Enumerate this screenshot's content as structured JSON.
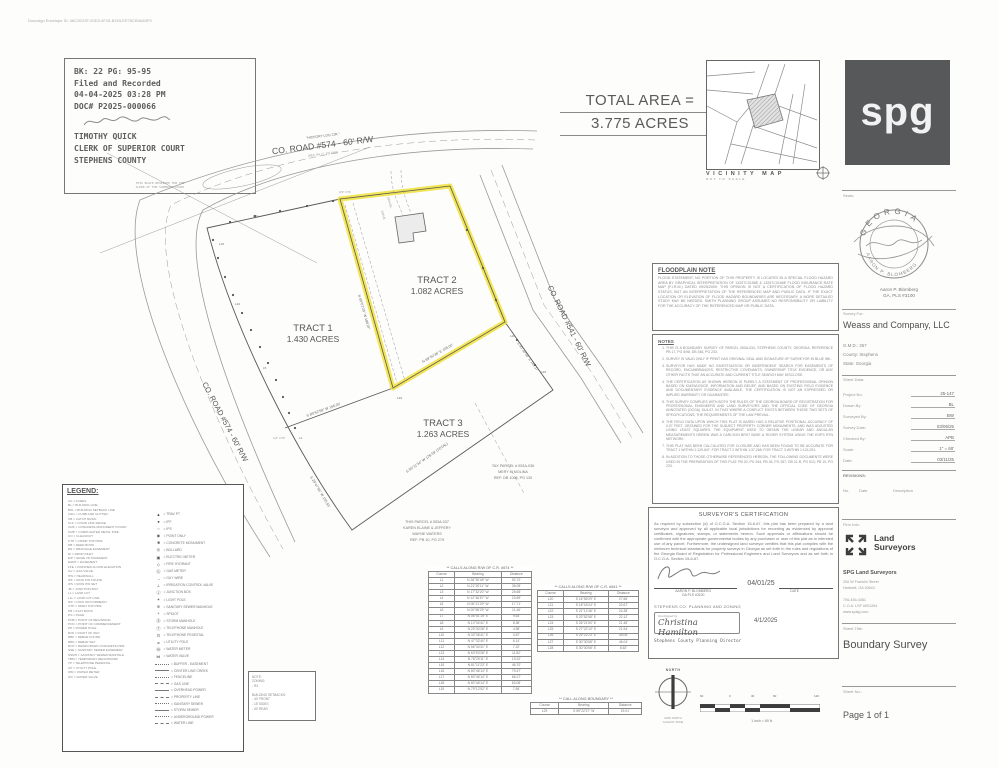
{
  "page": {
    "envelope_id": "Docusign Envelope ID: 46C2E23F-53D3-4F15-B153-EE76CB3A63F9"
  },
  "stamp": {
    "line1": "BK: 22 PG: 95-95",
    "line2": "Filed and Recorded",
    "line3": "04-04-2025 03:28 PM",
    "line4": "DOC# P2025-000066",
    "name": "TIMOTHY QUICK",
    "title": "CLERK OF SUPERIOR COURT",
    "county": "STEPHENS COUNTY",
    "footnote1": "THIS BLOCK RESERVED FOR THE",
    "footnote2": "CLERK OF THE SUPERIOR COURT"
  },
  "total_area": {
    "label": "TOTAL AREA =",
    "value": "3.775 ACRES"
  },
  "vicinity": {
    "title": "VICINITY MAP",
    "subtitle": "NOT TO SCALE"
  },
  "logo": {
    "text": "spg",
    "bg": "#57585a"
  },
  "drawing": {
    "road_top_name": "\"HICKORY LOG CIR.\"",
    "road_top": "CO. ROAD #574 - 60' R/W",
    "road_top_ref": "(REF. PB 17, PG 5/98)",
    "road_left": "CO. ROAD #574 - 60' R/W",
    "road_right": "CO. ROAD #541 - 60' R/W",
    "tract1_name": "TRACT 1",
    "tract1_area": "1.430 ACRES",
    "tract2_name": "TRACT 2",
    "tract2_area": "1.082 ACRES",
    "tract3_name": "TRACT 3",
    "tract3_area": "1.263 ACRES",
    "highlight_color": "#f0e13a",
    "gravel": "GRAVEL",
    "drive": "DRIVE",
    "bearings": [
      "N 00°07'26\" W  188.97'",
      "N 89°50'38\" E  165.00'",
      "S 89°52'58\" W  165.00'",
      "S 30°30'58\" E  141.17'",
      "S 59°11'34\" W  178.59' (TOTAL)",
      "S 29°47'56\" W  155.55'"
    ],
    "course_marks": [
      "L1",
      "L5",
      "L10",
      "L15",
      "L19",
      "L20",
      "L25",
      "L29"
    ],
    "corner_marks": [
      "3/4\" CTF",
      "1/2\" CTP"
    ],
    "adjoiner1": [
      "TAX PARCEL # 053A-036",
      "MERY M MOLINA",
      "REF: DB 1098, PG 130"
    ],
    "adjoiner2": [
      "THIS PARCEL # 053A-037",
      "KAREN ELAINE & JEFFERY",
      "WAYNE WATERS",
      "REF: PB 10, PG 279"
    ]
  },
  "floodplain": {
    "title": "FLOODPLAIN NOTE",
    "body": "FLOOD STATEMENT: NO PORTION OF THIS PROPERTY IS LOCATED IN A SPECIAL FLOOD HAZARD AREA BY GRAPHICAL INTERPRETATION OF 13257C0158E & 13257C0166E FLOOD INSURANCE RATE MAP (F.I.R.M.) DATED 09/25/2009. THIS OPINION IS NOT A CERTIFICATION OF FLOOD HAZARD STATUS, BUT AN INTERPRETATION OF THE REFERENCED MAP AND PUBLIC DATA. IF THE EXACT LOCATION OR ELEVATION OF FLOOD HAZARD BOUNDARIES ARE NECESSARY, A MORE DETAILED STUDY MAY BE NEEDED. SMITH PLANNING GROUP ASSUMES NO RESPONSIBILITY OR LIABILITY FOR THE ACCURACY OF THE REFERENCED MAP OR PUBLIC DATA."
  },
  "notes": {
    "title": "NOTES",
    "items": [
      "THIS IS A BOUNDARY SURVEY OF PARCEL 053A-034, STEPHENS COUNTY, GEORGIA. REFERENCE PB 17, PG 5/98; DB 346, PG 233.",
      "SURVEY IS VALID ONLY IF PRINT HAS ORIGINAL SEAL AND SIGNATURE OF SURVEYOR IN BLUE INK.",
      "SURVEYOR HAS MADE NO INVESTIGATION OR INDEPENDENT SEARCH FOR EASEMENTS OF RECORD, ENCUMBRANCES, RESTRICTIVE COVENANTS, OWNERSHIP TITLE EVIDENCE, OR ANY OTHER FACTS THAT AN ACCURATE AND CURRENT TITLE SEARCH MAY DISCLOSE.",
      "THE CERTIFICATION AS SHOWN HEREON IS PURELY A STATEMENT OF PROFESSIONAL OPINION BASED ON KNOWLEDGE, INFORMATION AND BELIEF, AND BASED ON EXISTING FIELD EVIDENCE AND DOCUMENTARY EVIDENCE AVAILABLE. THE CERTIFICATION IS NOT AN EXPRESSED OR IMPLIED WARRANTY OR GUARANTEE.",
      "THIS SURVEY COMPLIES WITH BOTH THE RULES OF THE GEORGIA BOARD OF REGISTRATION FOR PROFESSIONAL ENGINEERS AND LAND SURVEYORS AND THE OFFICIAL CODE OF GEORGIA ANNOTATED (OCGA) 15-6-67, IN THAT WHERE A CONFLICT EXISTS BETWEEN THOSE TWO SETS OF SPECIFICATIONS, THE REQUIREMENTS OF THE LAW PREVAIL.",
      "THE FIELD DATA UPON WHICH THIS PLAT IS BASED HAS A RELATIVE POSITIONAL ACCURACY OF 0.07 FEET, OBTAINED FOR THE SUBJECT PROPERTY CORNER MONUMENTS, AND WAS ADJUSTED USING LEAST SQUARES. THE EQUIPMENT USED TO OBTAIN THE LINEAR AND ANGULAR MEASUREMENTS HEREIN WAS A CARLSON BRX7 BASE & ROVER SYSTEM USING THE EGPS RTN NETWORK.",
      "THIS PLAT HAS BEEN CALCULATED FOR CLOSURE AND HAS BEEN FOUND TO BE ACCURATE FOR TRACT 1 WITHIN 1:129,847; FOR TRACT 2 WITHIN 1:37,268; FOR TRACT 3 WITHIN 1:124,291.",
      "IN ADDITION TO THOSE OTHERWISE REFERENCED HEREON, THE FOLLOWING DOCUMENTS WERE USED IN THE PREPARATION OF THIS PLAT: PB 20, PG 264; PB 28, PG 257; DB 21-R, PG 513; PB 10, PG 233."
    ]
  },
  "certification": {
    "title": "SURVEYOR'S CERTIFICATION",
    "body": "As required by subsection (d) of O.C.G.A. Section 15-6-67, this plat has been prepared by a land surveyor and approved by all applicable local jurisdictions for recording as evidenced by approval certificates, signatures, stamps, or statements hereon. Such approvals or affirmations should be confirmed with the appropriate governmental bodies by any purchaser or user of this plat as to intended use of any parcel. Furthermore, the undersigned land surveyor certifies that this plat complies with the minimum technical standards for property surveys in Georgia as set forth in the rules and regulations of the Georgia Board of Registration for Professional Engineers and Land Surveyors and as set forth in O.C.G.A. Section 15-6-67.",
    "date": "04/01/25",
    "surveyor_name": "AARON P. BLOMBERG",
    "surveyor_license": "GA PLS #3100",
    "date_label": "DATE",
    "agency": "STEPHENS CO. PLANNING AND ZONING",
    "ds_label": "DocuSigned by:",
    "ds_signature": "Christina Hamilton",
    "approval_date": "4/1/2025",
    "approver_title": "Stephens County Planning Director"
  },
  "legend": {
    "title": "LEGEND:",
    "abbreviations": [
      "AC = ACRES",
      "BL = BUILDING LINE",
      "BSL = BUILDING SETBACK LINE",
      "C&G = CURB AND GUTTER",
      "CB = CATCH BASIN",
      "CLF = CHAIN LINK FENCE",
      "CMF = CONCRETE MONUMENT FOUND",
      "CMP = CORRUGATED METAL PIPE",
      "CO = CLEANOUT",
      "CTP = CRIMP TOP PIPE",
      "DB = DEED BOOK",
      "DE = DRAINAGE EASEMENT",
      "DI = DROP INLET",
      "E/P = EDGE OF PAVEMENT",
      "ESMT = EASEMENT",
      "FFE = FINISHED FLOOR ELEVATION",
      "GV = GAS VALVE",
      "HW = HEADWALL",
      "IPF = IRON PIN FOUND",
      "IPS = IRON PIN SET",
      "JB = JUNCTION BOX",
      "LL = LAND LOT",
      "LLL = LAND LOT LINE",
      "N/F = NOW OR FORMERLY",
      "OTP = OPEN TOP PIPE",
      "PB = PLAT BOOK",
      "PG = PAGE",
      "POB = POINT OF BEGINNING",
      "POC = POINT OF COMMENCEMENT",
      "PP = POWER POLE",
      "R/W = RIGHT OF WAY",
      "RBF = REBAR FOUND",
      "RBS = REBAR SET",
      "RCP = REINFORCED CONCRETE PIPE",
      "SSE = SANITARY SEWER EASEMENT",
      "SSMH = SANITARY SEWER MANHOLE",
      "TBM = TEMPORARY BENCHMARK",
      "TP = TELEPHONE PEDESTAL",
      "UP = UTILITY POLE",
      "WM = WATER METER",
      "WV = WATER VALVE"
    ],
    "symbols": [
      {
        "g": "▲",
        "t": "= TRAV PT"
      },
      {
        "g": "●",
        "t": "= IPF"
      },
      {
        "g": "○",
        "t": "= IPS"
      },
      {
        "g": "◉",
        "t": "= POINT ONLY"
      },
      {
        "g": "■",
        "t": "= CONCRETE MONUMENT"
      },
      {
        "g": "◎",
        "t": "= BOLLARD"
      },
      {
        "g": "▣",
        "t": "= ELECTRIC METER"
      },
      {
        "g": "◇",
        "t": "= FIRE HYDRANT"
      },
      {
        "g": "Ⓖ",
        "t": "= GAS METER"
      },
      {
        "g": "→",
        "t": "= GUY WIRE"
      },
      {
        "g": "⊥",
        "t": "= IRRIGATION CONTROL VALVE"
      },
      {
        "g": "Ⓙ",
        "t": "= JUNCTION BOX"
      },
      {
        "g": "✶",
        "t": "= LIGHT POLE"
      },
      {
        "g": "⊕",
        "t": "= SANITARY SEWER MANHOLE"
      },
      {
        "g": "+",
        "t": "= SPIGOT"
      },
      {
        "g": "Ⓢ",
        "t": "= STORM MANHOLE"
      },
      {
        "g": "Ⓣ",
        "t": "= TELEPHONE MANHOLE"
      },
      {
        "g": "⊡",
        "t": "= TELEPHONE PEDESTAL"
      },
      {
        "g": "⌀",
        "t": "= UTILITY POLE"
      },
      {
        "g": "Ⓦ",
        "t": "= WATER METER"
      },
      {
        "g": "⋈",
        "t": "= WATER VALVE"
      }
    ],
    "linetypes": [
      "= BUFFER - EASEMENT",
      "= CENTER LINE CREEK",
      "= FENCELINE",
      "= GAS LINE",
      "= OVERHEAD POWER",
      "= PROPERTY LINE",
      "= SANITARY SEWER",
      "= STORM SEWER",
      "= UNDERGROUND POWER",
      "= WATER LINE"
    ]
  },
  "zoning_box": {
    "lines": [
      "NOTE:",
      "ZONING:",
      "- R3",
      "",
      "BUILDING SETBACKS:",
      "- 40' FRONT",
      "- 15' SIDES",
      "- 40' REAR"
    ]
  },
  "tables": {
    "t1": {
      "title": "** CALLS ALONG R/W OF C.R. #574 **",
      "headers": [
        "Course",
        "Bearing",
        "Distance"
      ],
      "rows": [
        {
          "c": "L1",
          "b": "N 26°30'48\" W",
          "d": "52.72'"
        },
        {
          "c": "L2",
          "b": "N 21°20'11\" W",
          "d": "36.08'"
        },
        {
          "c": "L3",
          "b": "N 17°32'20\" W",
          "d": "25.68'"
        },
        {
          "c": "L4",
          "b": "N 12°46'57\" W",
          "d": "23.69'"
        },
        {
          "c": "L5",
          "b": "N 06°21'29\" W",
          "d": "17.71'"
        },
        {
          "c": "L6",
          "b": "N 00°58'29\" W",
          "d": "11.46'"
        },
        {
          "c": "L7",
          "b": "N 06°51'19\" E",
          "d": "9.63'"
        },
        {
          "c": "L8",
          "b": "N 10°34'41\" E",
          "d": "8.36'"
        },
        {
          "c": "L9",
          "b": "N 25°30'28\" E",
          "d": "4.98'"
        },
        {
          "c": "L10",
          "b": "N 33°36'41\" E",
          "d": "3.87'"
        },
        {
          "c": "L11",
          "b": "N 47°32'40\" E",
          "d": "6.14'"
        },
        {
          "c": "L12",
          "b": "N 56°34'31\" E",
          "d": "7.22'"
        },
        {
          "c": "L13",
          "b": "N 63°53'28\" E",
          "d": "11.82'"
        },
        {
          "c": "L14",
          "b": "N 78°29'11\" E",
          "d": "19.22'"
        },
        {
          "c": "L15",
          "b": "N 81°11'23\" E",
          "d": "46.70'"
        },
        {
          "c": "L16",
          "b": "N 80°46'14\" E",
          "d": "79.47'"
        },
        {
          "c": "L17",
          "b": "N 80°46'14\" E",
          "d": "66.27'"
        },
        {
          "c": "L18",
          "b": "N 80°46'14\" E",
          "d": "63.08'"
        },
        {
          "c": "L19",
          "b": "N 79°12'52\" E",
          "d": "7.84'"
        }
      ]
    },
    "t2": {
      "title": "** CALLS ALONG R/W OF C.R. #541 **",
      "headers": [
        "Course",
        "Bearing",
        "Distance"
      ],
      "rows": [
        {
          "c": "L20",
          "b": "S 16°55'29\" E",
          "d": "27.66'"
        },
        {
          "c": "L21",
          "b": "S 18°18'24\" E",
          "d": "20.67'"
        },
        {
          "c": "L22",
          "b": "S 21°12'46\" E",
          "d": "24.38'"
        },
        {
          "c": "L23",
          "b": "S 23°52'58\" E",
          "d": "22.12'"
        },
        {
          "c": "L24",
          "b": "S 26°21'50\" E",
          "d": "21.48'"
        },
        {
          "c": "L25",
          "b": "S 27°22'10\" E",
          "d": "21.54'"
        },
        {
          "c": "L26",
          "b": "S 29°22'23\" E",
          "d": "45.05'"
        },
        {
          "c": "L27",
          "b": "S 30°30'58\" E",
          "d": "46.04'"
        },
        {
          "c": "L28",
          "b": "S 30°30'58\" E",
          "d": "8.63'"
        }
      ]
    },
    "t3": {
      "title": "** CALL ALONG BOUNDARY **",
      "headers": [
        "Course",
        "Bearing",
        "Distance"
      ],
      "rows": [
        {
          "c": "L29",
          "b": "S 59°22'37\" W",
          "d": "19.01'"
        }
      ]
    }
  },
  "compass": {
    "label": "NORTH",
    "sub1": "GRID NORTH",
    "sub2": "GA EAST ZONE"
  },
  "scalebar": {
    "ticks": [
      "60",
      "0",
      "30",
      "60",
      "120"
    ],
    "caption": "1 inch = 60 ft."
  },
  "titleblock": {
    "seals_label": "Seals:",
    "seal_arc_top": "GEORGIA",
    "seal_arc_bottom": "AARON P. BLOMBERG",
    "seal_name": "Aaron P. Blomberg",
    "seal_license": "GA, PLS #3100",
    "survey_for_label": "Survey For:",
    "client": "Weass and Company, LLC",
    "gmd": "G.M.D.: 267",
    "county": "County: Stephens",
    "state": "State: Georgia",
    "sheet_data_label": "Sheet Data:",
    "rows": [
      {
        "label": "Project No.",
        "value": "25-147"
      },
      {
        "label": "Drawn By:",
        "value": "BL"
      },
      {
        "label": "Surveyed By:",
        "value": "BW"
      },
      {
        "label": "Survey Date:",
        "value": "03/06/25"
      },
      {
        "label": "Checked By:",
        "value": "APB"
      },
      {
        "label": "Scale:",
        "value": "1\" = 60'"
      },
      {
        "label": "Date:",
        "value": "03/11/25"
      }
    ],
    "revisions_label": "REVISIONS:",
    "rev_no": "No.",
    "rev_date": "Date",
    "rev_desc": "Description",
    "firm_info_label": "Firm Info:",
    "firm_logo_line1": "Land",
    "firm_logo_line2": "Surveyors",
    "firm_name": "SPG Land Surveyors",
    "firm_address1": "206 W Franklin Street",
    "firm_address2": "Hartwell, GA 30643",
    "firm_phone": "706-436-4381",
    "firm_coa": "C.O.A. LSF #001264",
    "firm_web": "www.spslg.com",
    "sheet_title_label": "Sheet Title:",
    "sheet_title": "Boundary Survey",
    "sheet_no_label": "Sheet No.:",
    "sheet_no": "Page 1 of 1"
  }
}
